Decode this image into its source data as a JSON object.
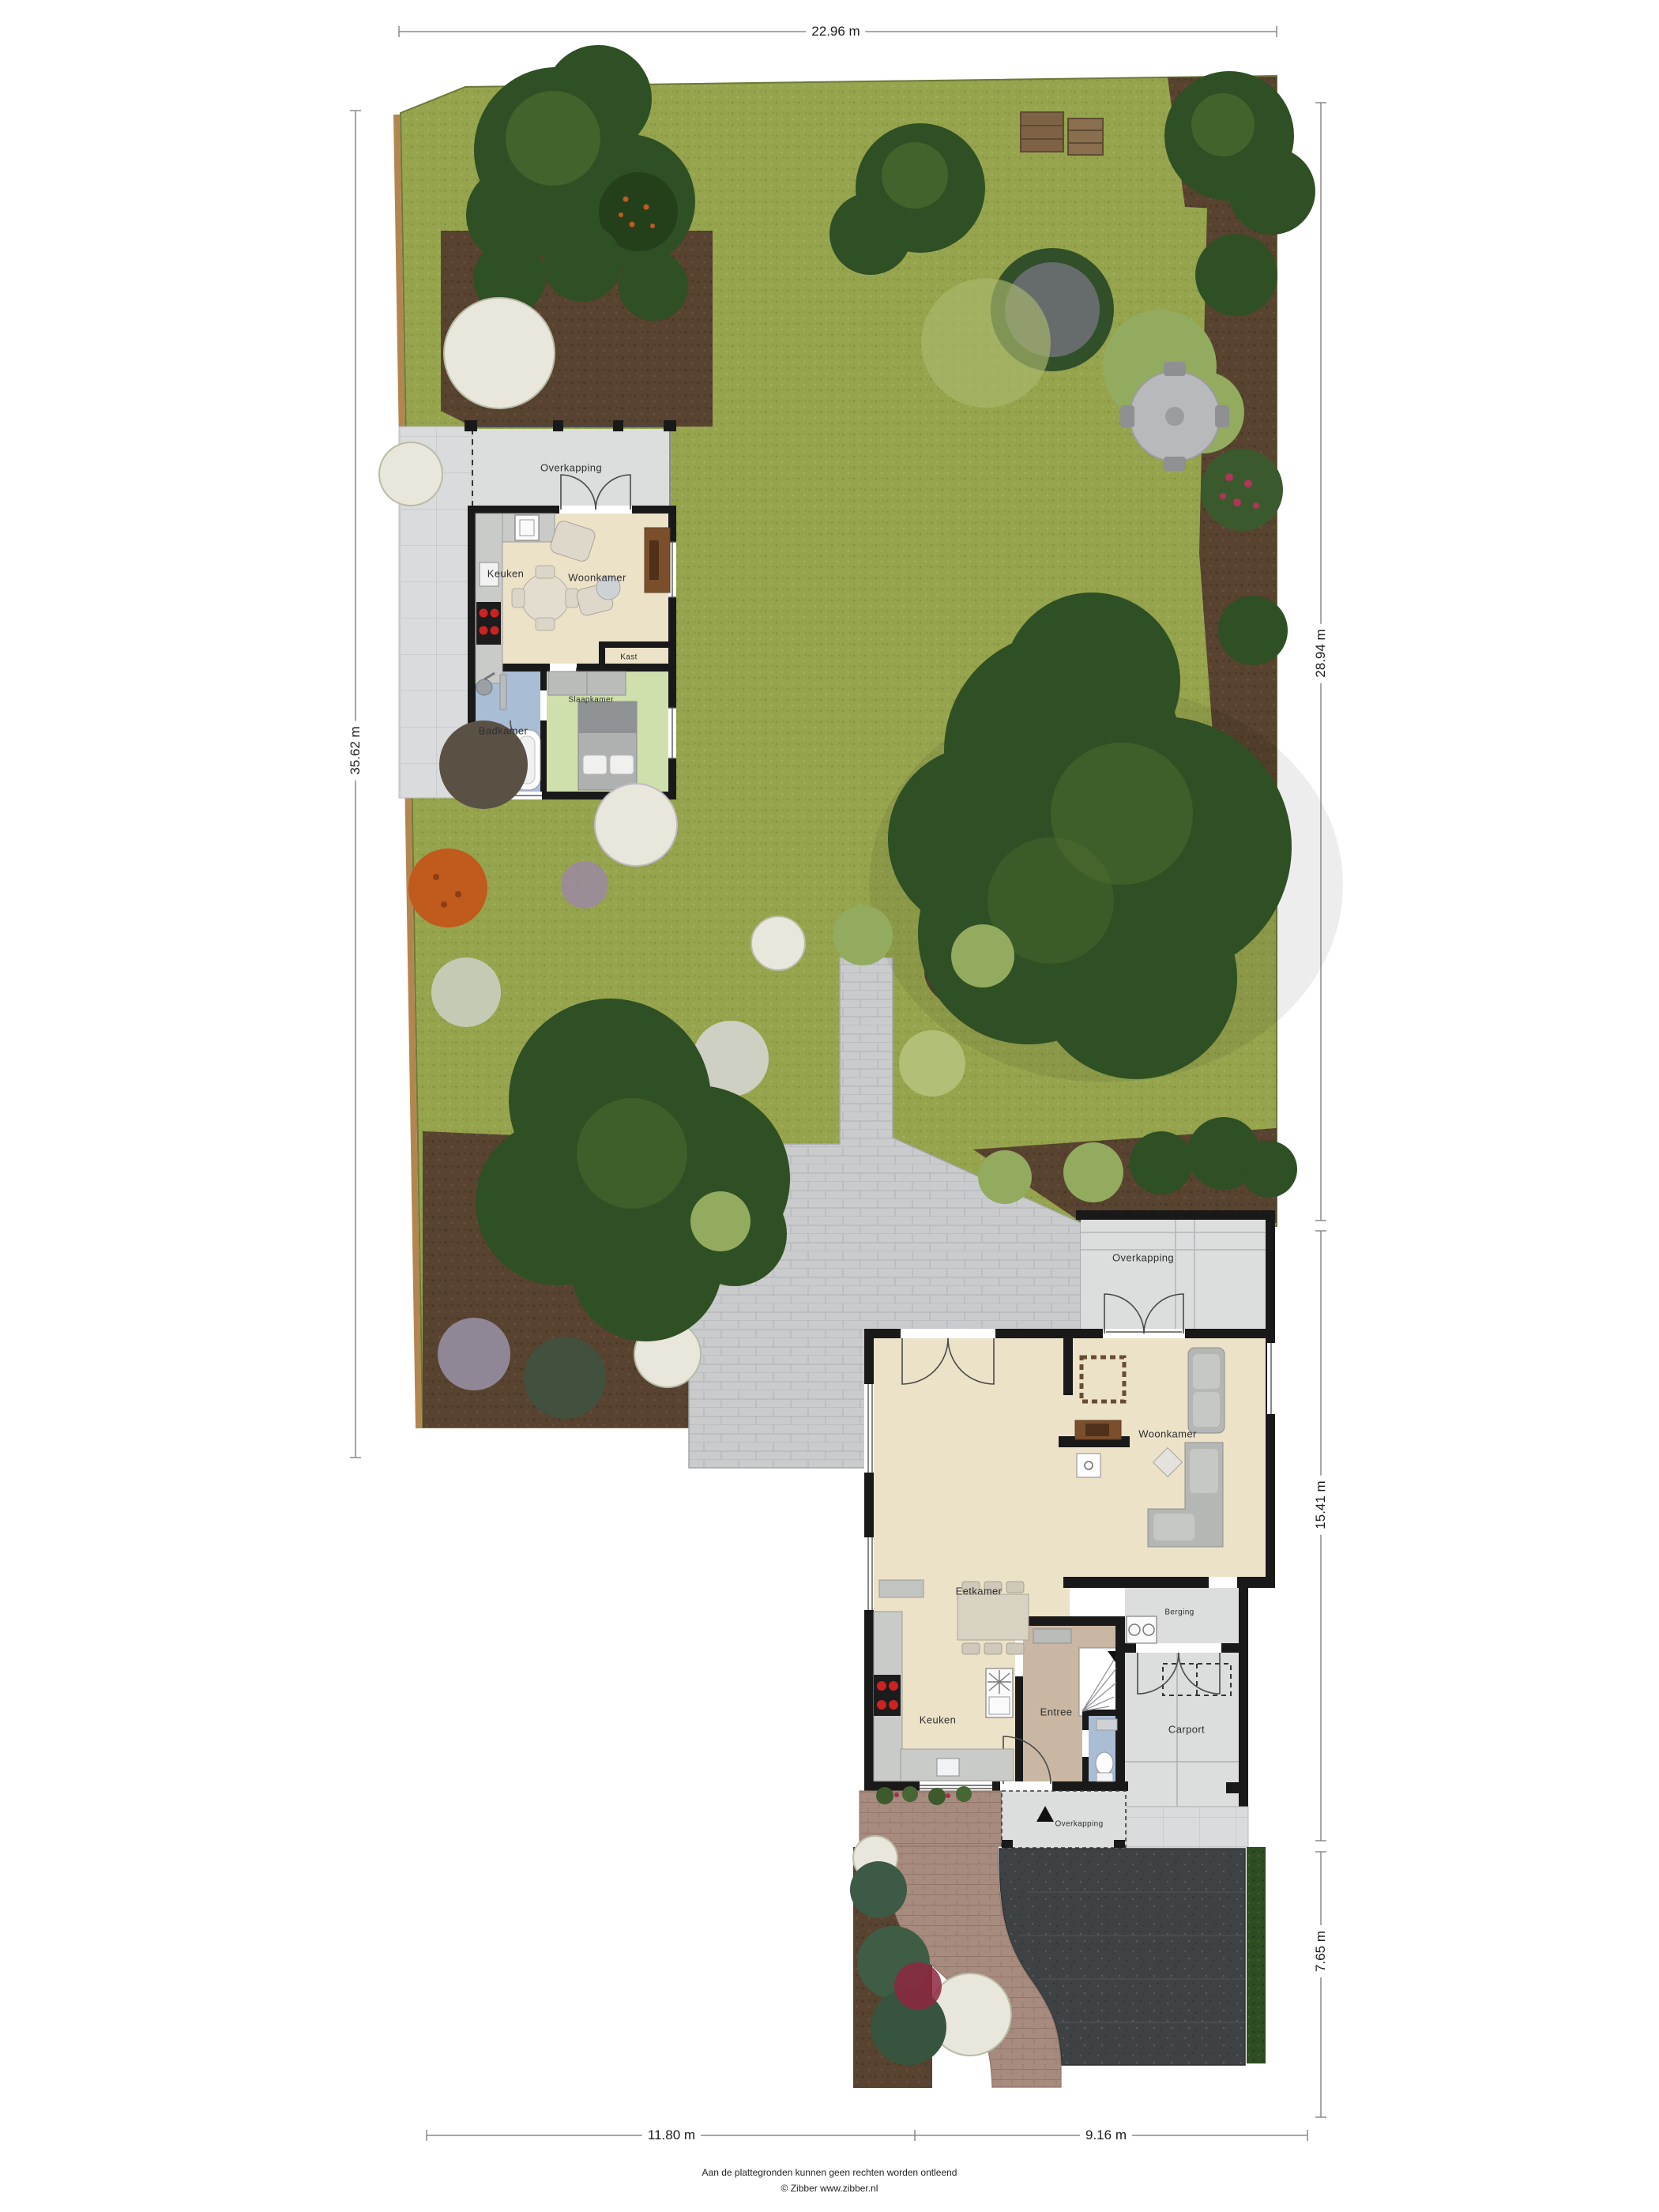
{
  "dimensions": {
    "top": "22.96 m",
    "left": "35.62 m",
    "right_top": "28.94 m",
    "right_middle": "15.41 m",
    "right_bottom": "7.65 m",
    "bottom_left": "11.80 m",
    "bottom_right": "9.16 m"
  },
  "garden_house": {
    "overkapping": "Overkapping",
    "keuken": "Keuken",
    "woonkamer": "Woonkamer",
    "kast": "Kast",
    "badkamer": "Badkamer",
    "slaapkamer": "Slaapkamer"
  },
  "main_house": {
    "overkapping_rear": "Overkapping",
    "woonkamer": "Woonkamer",
    "eetkamer": "Eetkamer",
    "keuken": "Keuken",
    "entree": "Entree",
    "berging": "Berging",
    "carport": "Carport",
    "overkapping_front": "Overkapping"
  },
  "footer": {
    "line1": "Aan de plattegronden kunnen geen rechten worden ontleend",
    "line2": "© Zibber www.zibber.nl"
  },
  "colors": {
    "grass": "#96a44e",
    "grass_dot": "#88973f",
    "soil": "#57432f",
    "soil_dot": "#493826",
    "paving": "#c9cbcd",
    "paving_line": "#b0b3b5",
    "tile": "#dadbdc",
    "tile_line": "#c3c4c6",
    "gravel": "#3f4244",
    "gravel_dot": "#585b5d",
    "brick_path": "#a68b7e",
    "brick_path_line": "#93776a",
    "hedge": "#2e4d22",
    "wall": "#191919",
    "floor_cream": "#ebe2c8",
    "floor_gray": "#dcdddd",
    "floor_tan": "#cab7a3",
    "bath_blue": "#a9bdd5",
    "bed_green": "#cfe0ad",
    "wood": "#7c4f2c",
    "sofa_gray": "#b5b7b5",
    "tree_dark": "#2f4f24",
    "tree_light_spot": "#537434",
    "bush_light": "#93ab5f",
    "bush_white": "#e9e7dc",
    "flower_purple": "#9c86ae",
    "flower_red": "#8e2740",
    "flower_orange": "#c05a1d",
    "fence": "#b5854f",
    "dim_line": "#8a8a8a"
  }
}
